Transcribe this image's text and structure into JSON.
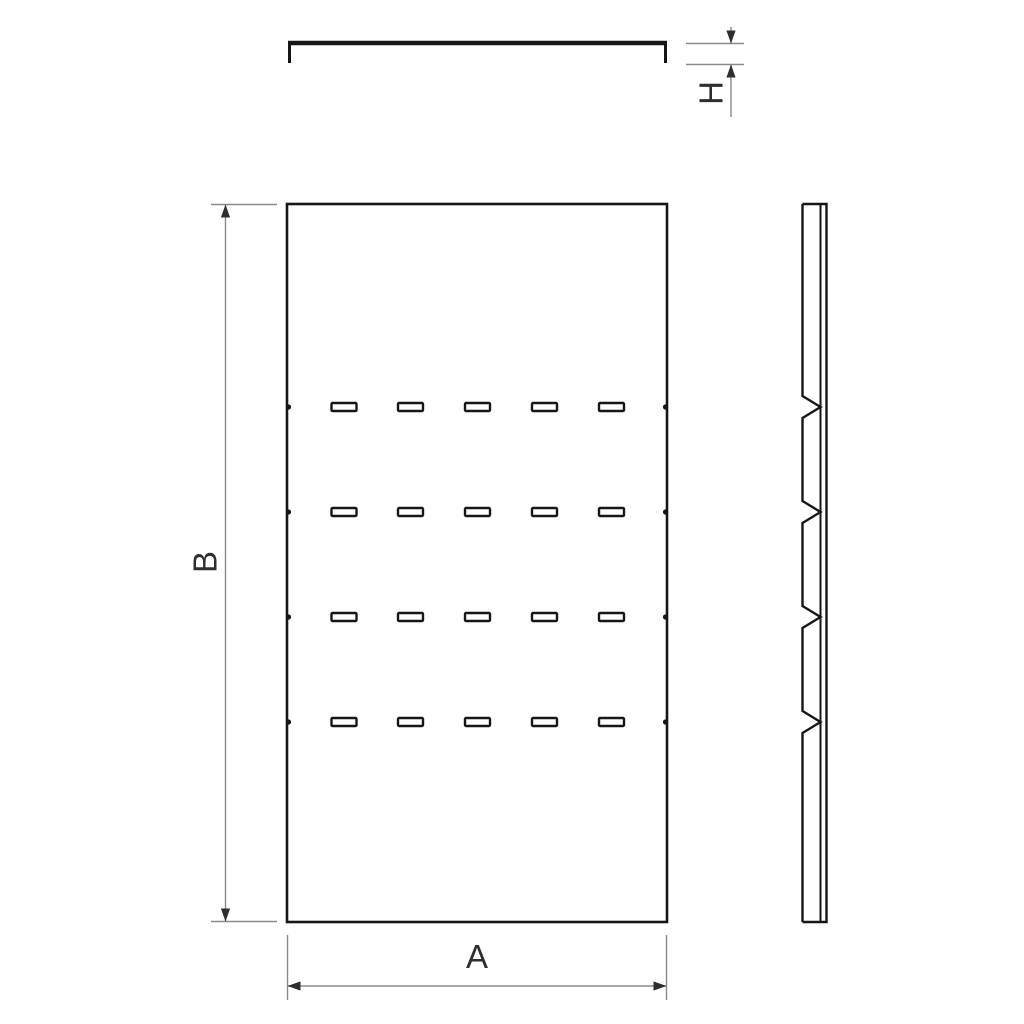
{
  "drawing": {
    "type": "technical-drawing",
    "description": "Three orthographic views of a slotted cover plate with flanged edges and crimp notches",
    "dimension_labels": {
      "width": "A",
      "height": "B",
      "flange_height": "H"
    },
    "colors": {
      "line": "#161616",
      "dim_line": "#8a8a8a",
      "arrow": "#2e2e2e",
      "text": "#2e2e2e",
      "background": "#ffffff"
    },
    "top_view": {
      "x1": 288,
      "x2": 667,
      "bar_y": 43,
      "flange_bottom_y": 63,
      "bar_stroke": 4.5,
      "leg_stroke": 3
    },
    "front_view": {
      "x": 287,
      "y": 204,
      "width": 380,
      "height": 718,
      "rows": 4,
      "columns": 5,
      "slot_rows_y": [
        407,
        512,
        617,
        722
      ],
      "slot_cols_x": [
        344,
        410.5,
        477.5,
        544.5,
        611.5
      ],
      "slot_width": 25,
      "slot_height": 8
    },
    "side_view": {
      "left_x": 802.5,
      "inner_x": 820.5,
      "right_x": 826.5,
      "top_y": 204,
      "bottom_y": 922,
      "notch_ys": [
        407,
        512,
        617,
        722
      ],
      "notch_half": 11
    },
    "dim_A": {
      "line_y": 986,
      "x1": 287.5,
      "x2": 666.5,
      "ext_y1": 935,
      "ext_y2": 1000,
      "label_x": 477,
      "label_y": 968
    },
    "dim_B": {
      "line_x": 225.5,
      "y1": 204.5,
      "y2": 921.5,
      "ext_x1": 211,
      "ext_x2": 277,
      "label_x": 205,
      "label_y": 562
    },
    "dim_H": {
      "line_x": 731,
      "ext_x1": 686,
      "ext_x2": 744,
      "y1": 43.5,
      "y2": 64.5,
      "tail_top_y": 27,
      "tail_bottom_y": 117,
      "label_x": 711,
      "label_y": 93
    }
  }
}
